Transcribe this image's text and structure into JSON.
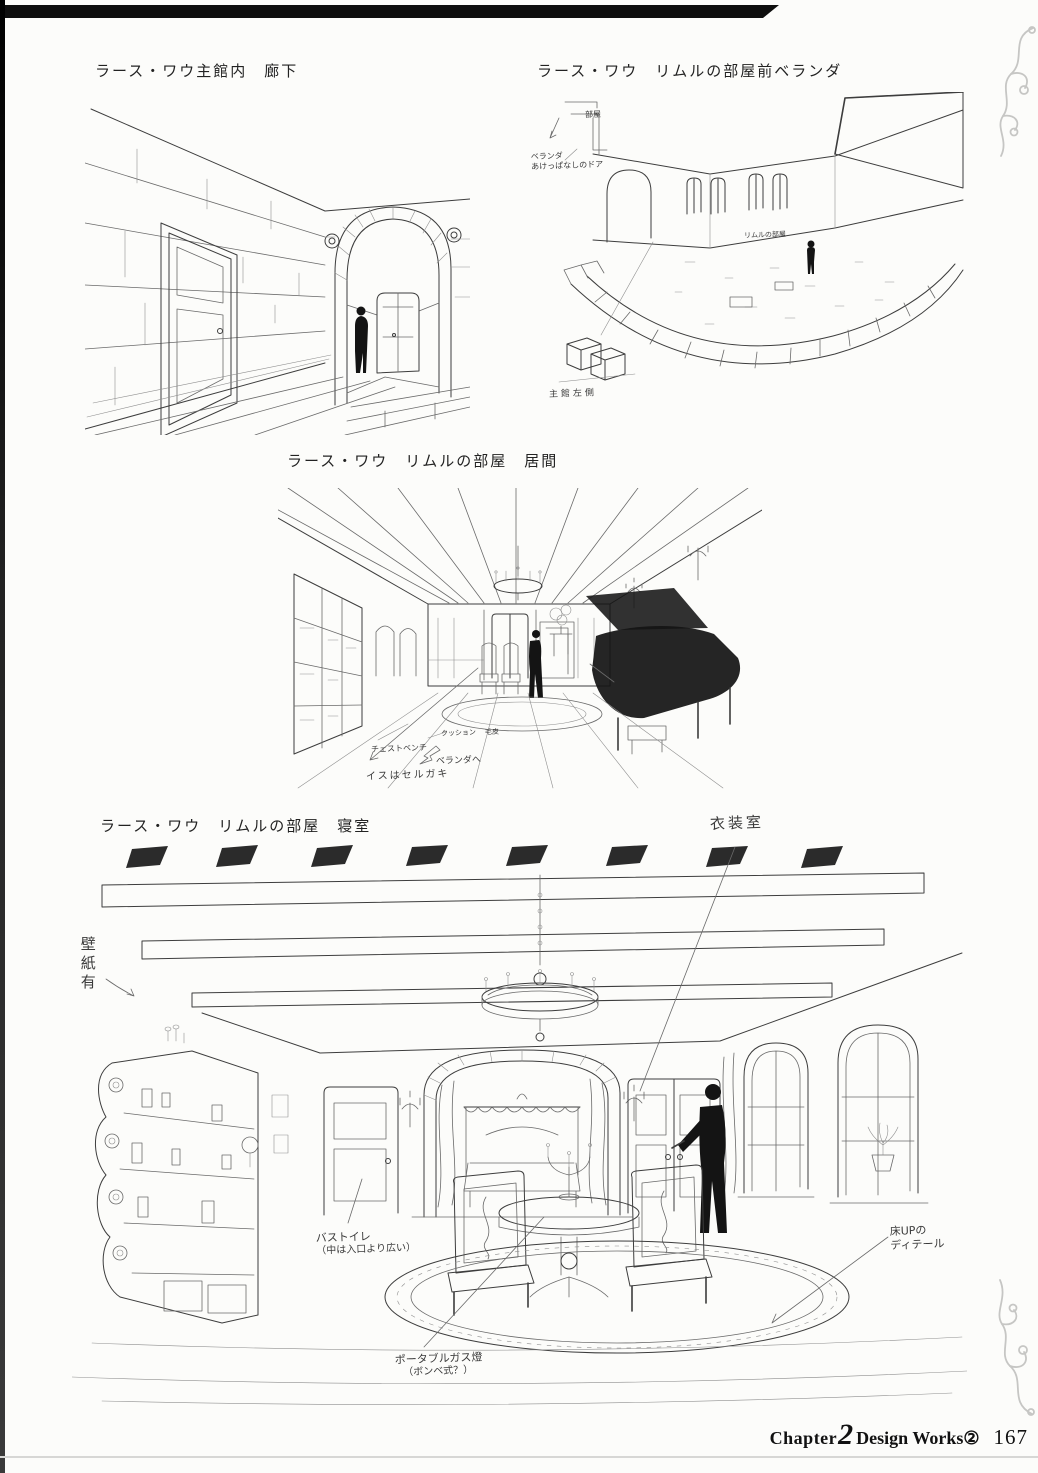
{
  "footer": {
    "chapter_label": "Chapter",
    "chapter_number": "2",
    "works_label": "Design Works②",
    "page_number": "167"
  },
  "panels": {
    "corridor": {
      "caption": "ラース・ワウ主館内　廊下"
    },
    "veranda": {
      "caption": "ラース・ワウ　リムルの部屋前ベランダ",
      "plan_room_label": "部屋",
      "door_note_line1": "ベランダ",
      "door_note_line2": "あけっぱなしのドア",
      "courtyard_label": "リムルの部屋",
      "detail_note": "主館左側"
    },
    "living_room": {
      "caption": "ラース・ワウ　リムルの部屋　居間",
      "label_chest_bench": "チェストベンチ",
      "label_cushion": "クッション",
      "label_fur": "毛皮",
      "label_to_veranda": "ベランダへ",
      "note_chairs": "イスはセルガキ"
    },
    "bedroom": {
      "caption": "ラース・ワウ　リムルの部屋　寝室",
      "label_dressing_room": "衣装室",
      "label_wallpaper": "壁紙有",
      "note_bath_line1": "バストイレ",
      "note_bath_line2": "（中は入口より広い）",
      "note_lamp_line1": "ポータブルガス燈",
      "note_lamp_line2": "（ボンベ式？）",
      "note_floor_line1": "床UPの",
      "note_floor_line2": "ディテール"
    }
  }
}
